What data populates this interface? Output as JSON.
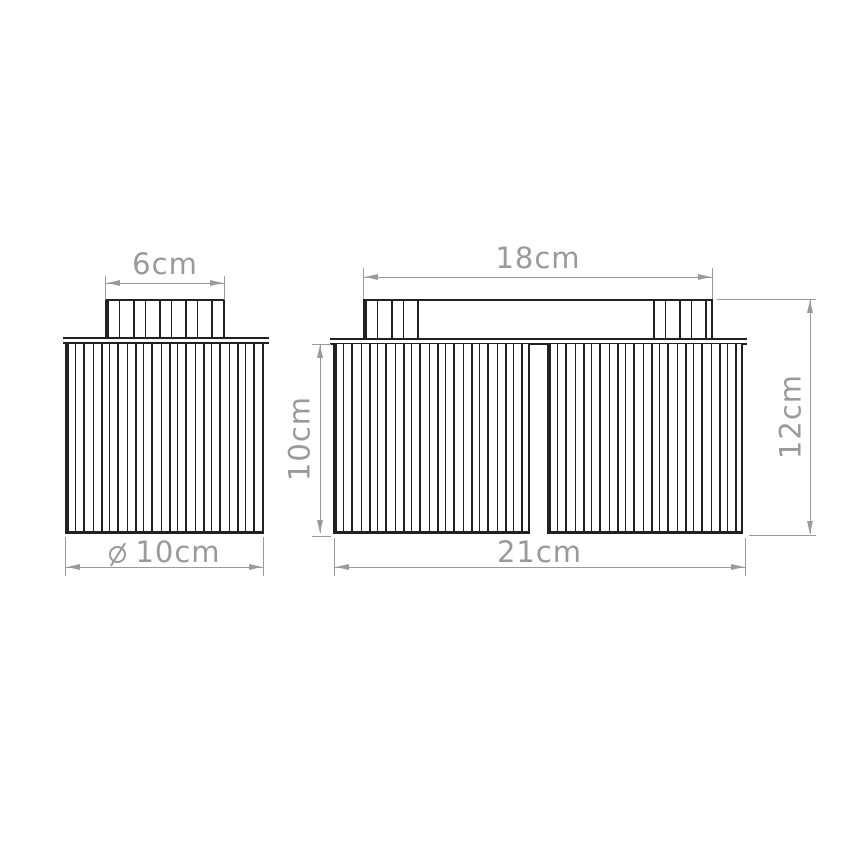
{
  "drawing": {
    "kind": "dimensioned technical line drawing of two ceiling light fixtures (front views)",
    "views": {
      "single": {
        "name": "single-shade fixture",
        "dimensions": {
          "canopy_width": "6cm",
          "shade_diameter": "10cm",
          "shade_diameter_symbol": "diameter-icon"
        }
      },
      "double": {
        "name": "double-shade fixture",
        "dimensions": {
          "canopy_width": "18cm",
          "shade_height": "10cm",
          "total_height": "12cm",
          "total_width": "21cm"
        }
      }
    },
    "colors": {
      "outline": "#212121",
      "dimension": "#9a9a9a",
      "background": "#ffffff"
    }
  }
}
